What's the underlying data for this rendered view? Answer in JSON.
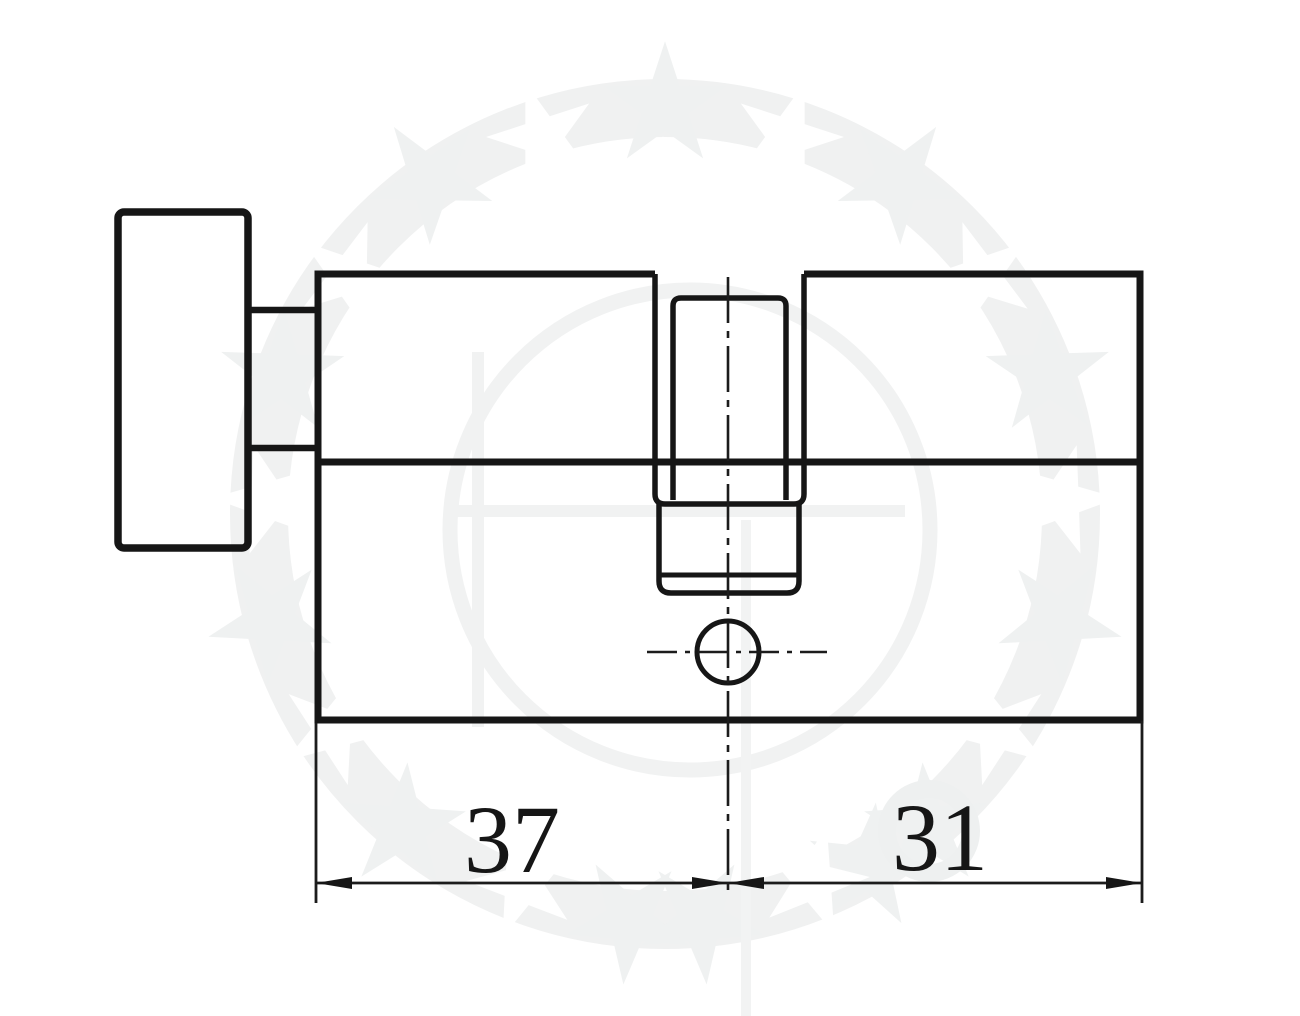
{
  "colors": {
    "line": "#161616",
    "watermark": "#f0f1f1",
    "background": "#ffffff"
  },
  "dimensions": {
    "left": {
      "value": "37"
    },
    "right": {
      "value": "31"
    }
  }
}
